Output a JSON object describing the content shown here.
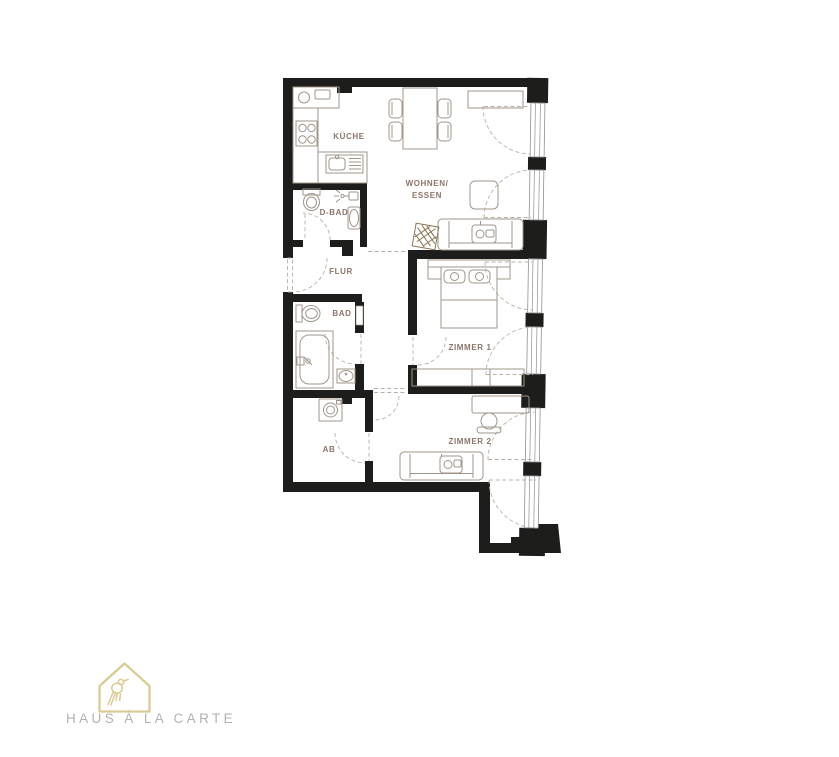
{
  "floorplan": {
    "colors": {
      "wall": "#1d1d1b",
      "furniture_outline": "#a0948a",
      "label": "#8c7468",
      "door_dash": "#b9b0a6",
      "window_frame": "#8f8f8f"
    },
    "labels": {
      "kueche": "KÜCHE",
      "wohnen_line1": "WOHNEN/",
      "wohnen_line2": "ESSEN",
      "d_bad": "D-BAD",
      "flur": "FLUR",
      "bad": "BAD",
      "ab": "AB",
      "zimmer1": "ZIMMER 1",
      "zimmer2": "ZIMMER 2"
    }
  },
  "branding": {
    "logo_text": "HAUS À LA CARTE",
    "logo_icon": "house-with-bird-icon",
    "logo_color": "#d9cb92",
    "logo_text_color": "#b3b2ae"
  }
}
